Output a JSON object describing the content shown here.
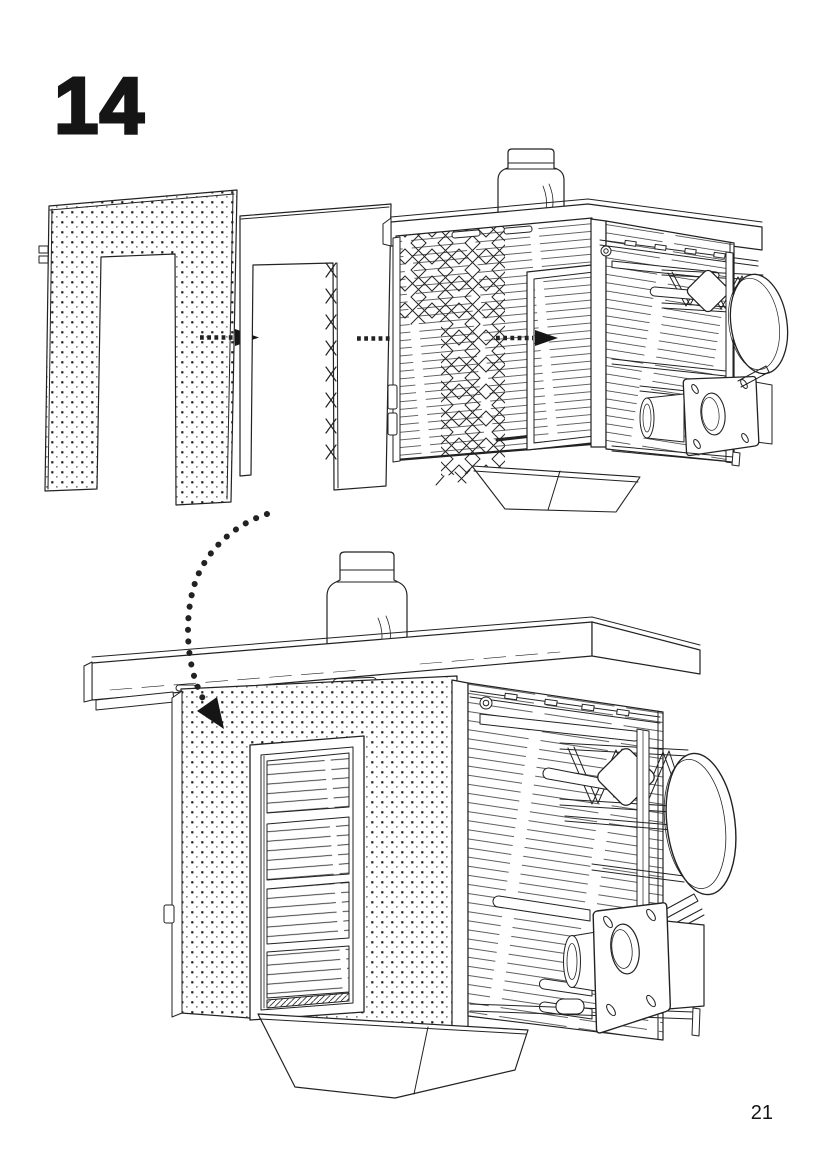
{
  "page": {
    "step_number": "14",
    "page_number": "21"
  },
  "icons": {
    "assembly_arrow": "dotted-arrow-right",
    "placement_arrow": "curved-dotted-arrow-down",
    "wall_texture": "halftone-dot-grid",
    "trim_texture": "diagonal-lattice"
  }
}
